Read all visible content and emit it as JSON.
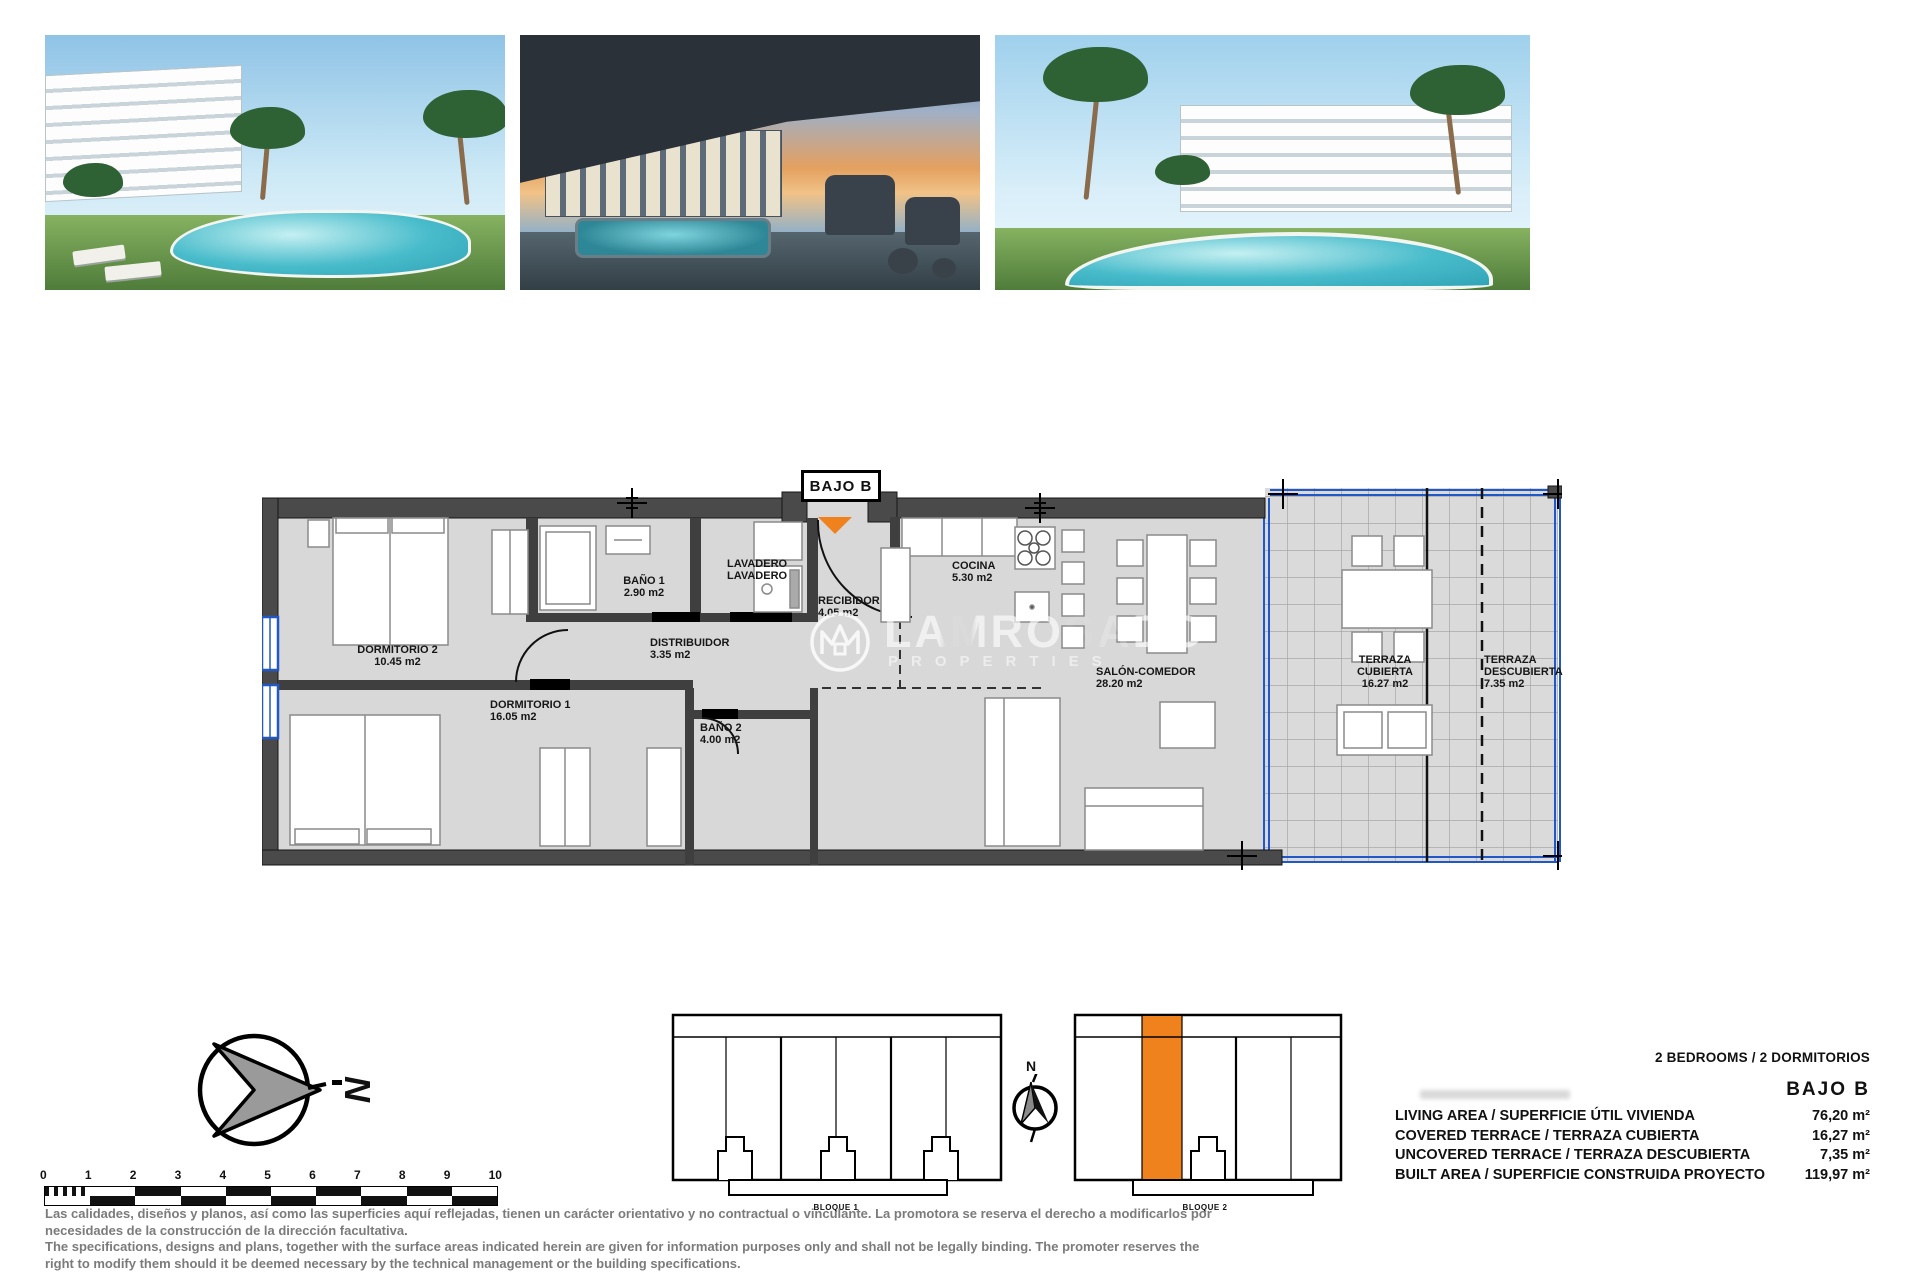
{
  "plan": {
    "unit_label": "BAJO B",
    "rooms": [
      {
        "name": "DORMITORIO 2",
        "area": "10.45 m2"
      },
      {
        "name": "BAÑO 1",
        "area": "2.90 m2"
      },
      {
        "name": "LAVADERO\nLAVADERO",
        "area": ""
      },
      {
        "name": "RECIBIDOR",
        "area": "4.05 m2"
      },
      {
        "name": "DISTRIBUIDOR",
        "area": "3.35 m2"
      },
      {
        "name": "DORMITORIO 1",
        "area": "16.05 m2"
      },
      {
        "name": "BAÑO 2",
        "area": "4.00 m2"
      },
      {
        "name": "COCINA",
        "area": "5.30 m2"
      },
      {
        "name": "SALÓN-COMEDOR",
        "area": "28.20 m2"
      },
      {
        "name": "TERRAZA\nCUBIERTA",
        "area": "16.27 m2"
      },
      {
        "name": "TERRAZA\nDESCUBIERTA",
        "area": "7.35 m2"
      }
    ]
  },
  "watermark": {
    "brand": "LAMROSADO",
    "sub": "PROPERTIES"
  },
  "summary": {
    "bedrooms_line": "2 BEDROOMS / 2 DORMITORIOS",
    "unit": "BAJO B",
    "rows": [
      {
        "label": "LIVING AREA / SUPERFICIE ÚTIL VIVIENDA",
        "value": "76,20 m²"
      },
      {
        "label": "COVERED TERRACE / TERRAZA CUBIERTA",
        "value": "16,27 m²"
      },
      {
        "label": "UNCOVERED TERRACE / TERRAZA DESCUBIERTA",
        "value": "7,35 m²"
      },
      {
        "label": "BUILT AREA / SUPERFICIE CONSTRUIDA PROYECTO",
        "value": "119,97 m²"
      }
    ]
  },
  "blocks": {
    "block1": "BLOQUE 1",
    "block2": "BLOQUE 2"
  },
  "compass": {
    "north": "N",
    "north_small": "N"
  },
  "scalebar": {
    "ticks": [
      "0",
      "1",
      "2",
      "3",
      "4",
      "5",
      "6",
      "7",
      "8",
      "9",
      "10"
    ]
  },
  "disclaimer": {
    "lines": [
      "Las calidades, diseños y planos, así como las superficies aquí reflejadas, tienen un carácter orientativo y no contractual o vinculante. La promotora se reserva el derecho a modificarlos por",
      "necesidades de la construcción de la dirección facultativa.",
      "The specifications, designs and plans, together with the surface areas indicated herein are given for information purposes only and shall not be legally binding. The promoter reserves the",
      "right to modify them should it be deemed necessary by the technical management or the building specifications."
    ]
  },
  "colors": {
    "accent_orange": "#f0821e",
    "glazing_blue": "#2058c8",
    "wall_gray": "#4a4a4a",
    "floor_gray": "#d8d8d8"
  }
}
